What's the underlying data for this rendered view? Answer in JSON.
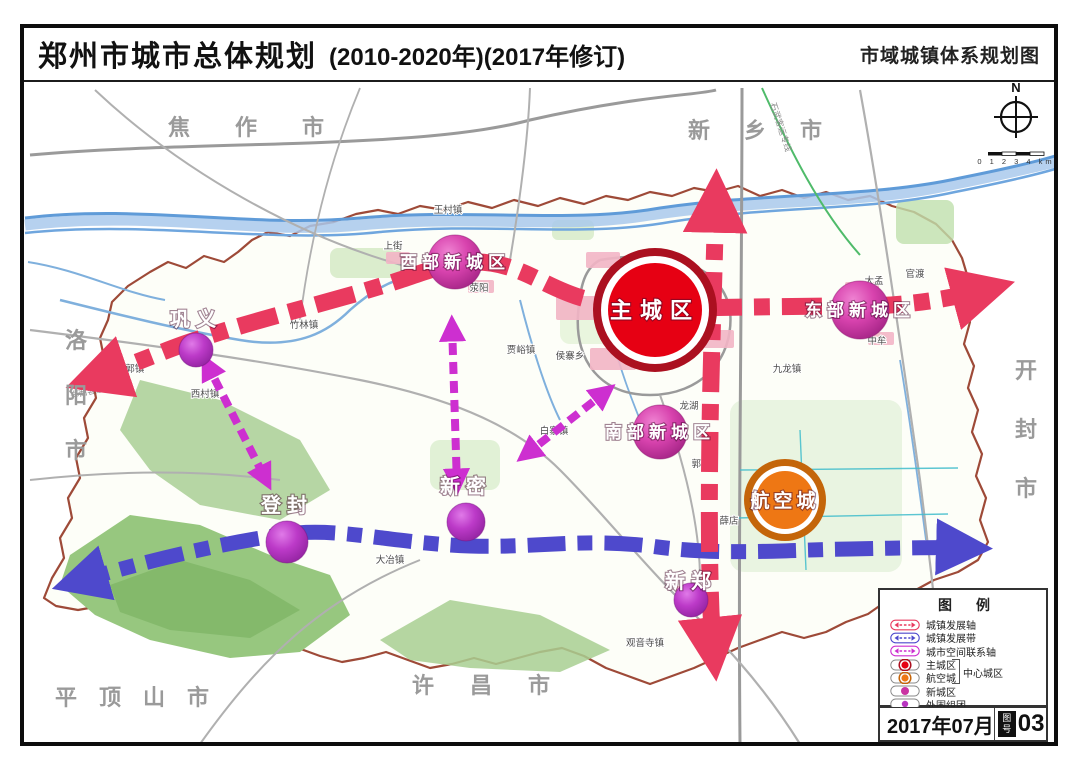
{
  "header": {
    "title": "郑州市城市总体规划",
    "subtitle": "(2010-2020年)(2017年修订)",
    "map_name": "市域城镇体系规划图"
  },
  "compass": {
    "north_label": "N",
    "scale_text": "0 1 2 3 4 km"
  },
  "colors": {
    "axis_red": "#e93a5f",
    "axis_blue": "#4e49cc",
    "axis_link": "#cd2fd0",
    "main_fill": "#e60013",
    "main_ring": "#ab1020",
    "aviation_fill": "#ee7714",
    "aviation_ring": "#c4650a",
    "newcity_fill": "#ca34a2",
    "outer_fill": "#b835c0",
    "boundary": "#9e4a38"
  },
  "map": {
    "nodes": [
      {
        "label": "主城区",
        "type": "main",
        "x": 655,
        "y": 310,
        "r": 47
      },
      {
        "label": "航空城",
        "type": "aviation",
        "x": 785,
        "y": 500,
        "r": 29
      },
      {
        "label": "西部新城区",
        "type": "new",
        "x": 455,
        "y": 262,
        "r": 27
      },
      {
        "label": "东部新城区",
        "type": "new",
        "x": 860,
        "y": 310,
        "r": 29
      },
      {
        "label": "南部新城区",
        "type": "new",
        "x": 660,
        "y": 432,
        "r": 27
      },
      {
        "label": "巩义",
        "type": "outer",
        "x": 196,
        "y": 350,
        "r": 17,
        "ldy": -24
      },
      {
        "label": "登封",
        "type": "outer",
        "x": 287,
        "y": 542,
        "r": 21,
        "ldy": -30
      },
      {
        "label": "新密",
        "type": "outer",
        "x": 466,
        "y": 522,
        "r": 19,
        "ldy": -29
      },
      {
        "label": "新郑",
        "type": "outer",
        "x": 691,
        "y": 600,
        "r": 17,
        "ldy": -12
      }
    ],
    "neighbor_cities": [
      {
        "label": "焦作市",
        "dir": "h",
        "x": 168,
        "y": 135,
        "spacing": 45
      },
      {
        "label": "新乡市",
        "dir": "h",
        "x": 688,
        "y": 138,
        "spacing": 34
      },
      {
        "label": "洛阳市",
        "dir": "v",
        "x": 76,
        "y": 348,
        "gap": 55
      },
      {
        "label": "开封市",
        "dir": "v",
        "x": 1026,
        "y": 378,
        "gap": 59
      },
      {
        "label": "平顶山市",
        "dir": "h",
        "x": 55,
        "y": 705,
        "spacing": 22
      },
      {
        "label": "许昌市",
        "dir": "h",
        "x": 412,
        "y": 693,
        "spacing": 36
      }
    ],
    "towns": [
      {
        "label": "荥阳",
        "x": 479,
        "y": 291
      },
      {
        "label": "上街",
        "x": 393,
        "y": 249
      },
      {
        "label": "王村镇",
        "x": 448,
        "y": 213
      },
      {
        "label": "竹林镇",
        "x": 304,
        "y": 328
      },
      {
        "label": "回郭镇",
        "x": 130,
        "y": 372
      },
      {
        "label": "西村镇",
        "x": 205,
        "y": 397
      },
      {
        "label": "贾峪镇",
        "x": 521,
        "y": 353
      },
      {
        "label": "侯寨乡",
        "x": 570,
        "y": 359
      },
      {
        "label": "白寨镇",
        "x": 554,
        "y": 434
      },
      {
        "label": "龙湖",
        "x": 689,
        "y": 409
      },
      {
        "label": "郭店",
        "x": 701,
        "y": 467
      },
      {
        "label": "薛店",
        "x": 729,
        "y": 524
      },
      {
        "label": "大孟",
        "x": 874,
        "y": 284
      },
      {
        "label": "官渡",
        "x": 915,
        "y": 277
      },
      {
        "label": "中牟",
        "x": 877,
        "y": 344
      },
      {
        "label": "九龙镇",
        "x": 787,
        "y": 372
      },
      {
        "label": "大冶镇",
        "x": 390,
        "y": 563
      },
      {
        "label": "观音寺镇",
        "x": 645,
        "y": 646
      }
    ],
    "road_labels": [
      {
        "label": "郑西客运专线",
        "x": 96,
        "y": 393,
        "rot": -12
      },
      {
        "label": "石武客运专线",
        "x": 778,
        "y": 128,
        "rot": 72
      }
    ]
  },
  "legend": {
    "title": "图例",
    "items": [
      {
        "label": "城镇发展轴",
        "symbol": "axis-red"
      },
      {
        "label": "城镇发展带",
        "symbol": "axis-blue"
      },
      {
        "label": "城市空间联系轴",
        "symbol": "axis-magenta"
      },
      {
        "label": "主城区",
        "symbol": "dot-main"
      },
      {
        "label": "航空城",
        "symbol": "dot-aviation"
      },
      {
        "label": "新城区",
        "symbol": "dot-new"
      },
      {
        "label": "外围组团",
        "symbol": "dot-outer"
      }
    ],
    "bracket_label": "中心城区"
  },
  "titleblock": {
    "date": "2017年07月",
    "sheet_word_top": "图",
    "sheet_word_bottom": "号",
    "sheet_number": "03"
  }
}
